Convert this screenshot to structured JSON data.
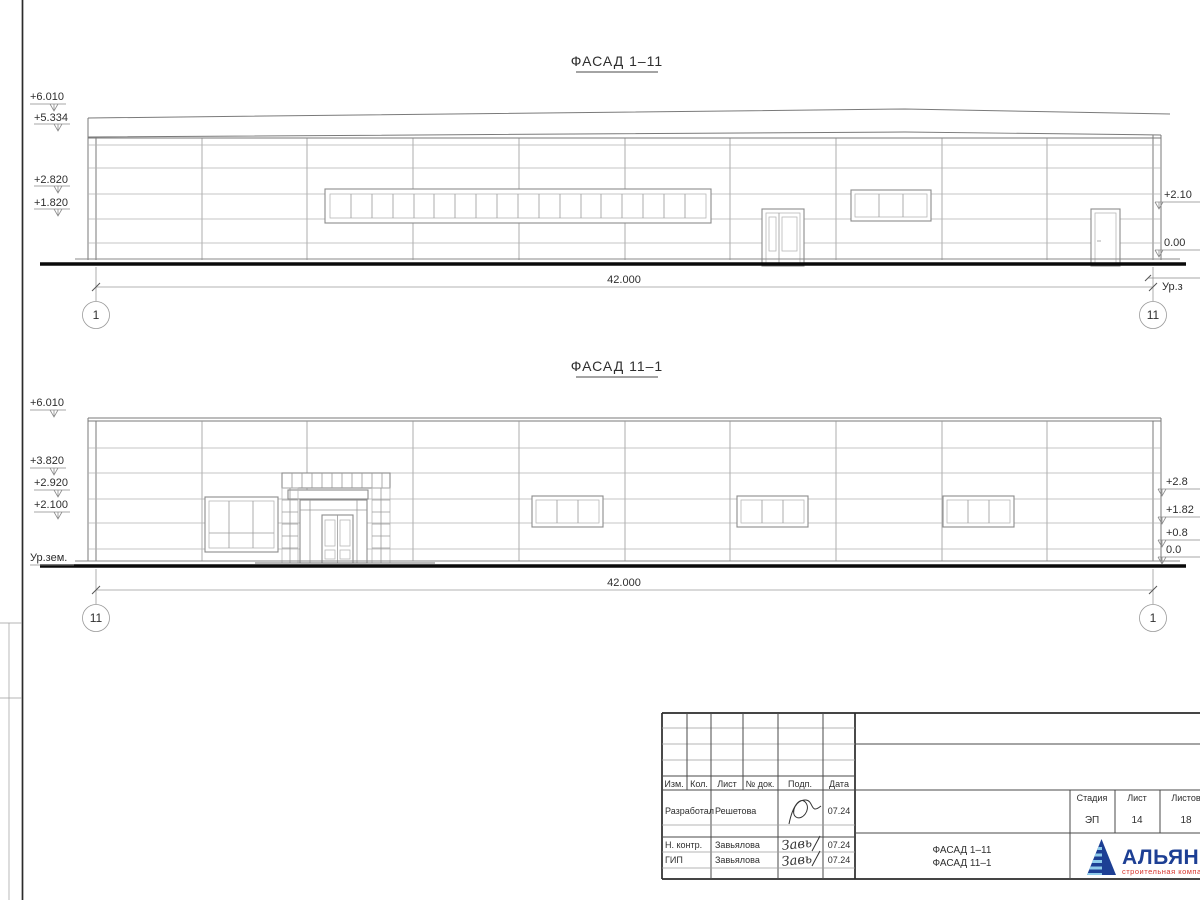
{
  "facade_top": {
    "title": "ФАСАД 1–11",
    "dimension": "42.000",
    "grid_left": "1",
    "grid_right": "11",
    "levels_left": [
      "+6.010",
      "+5.334",
      "+2.820",
      "+1.820"
    ],
    "levels_right": [
      "+2.10",
      "0.00"
    ],
    "ground_label_right": "Ур.з"
  },
  "facade_bottom": {
    "title": "ФАСАД 11–1",
    "dimension": "42.000",
    "grid_left": "11",
    "grid_right": "1",
    "levels_left": [
      "+6.010",
      "+3.820",
      "+2.920",
      "+2.100"
    ],
    "ground_label_left": "Ур.зем.",
    "levels_right": [
      "+2.8",
      "+1.82",
      "+0.8",
      "0.0"
    ]
  },
  "title_block": {
    "columns": [
      "Изм.",
      "Кол.",
      "Лист",
      "№ док.",
      "Подп.",
      "Дата"
    ],
    "rows": [
      {
        "role": "Разработал",
        "name": "Решетова",
        "sig": "",
        "date": "07.24"
      },
      {
        "role": "Н. контр.",
        "name": "Завьялова",
        "sig": "Завь",
        "date": "07.24"
      },
      {
        "role": "ГИП",
        "name": "Завьялова",
        "sig": "Завь",
        "date": "07.24"
      }
    ],
    "stage_label": "Стадия",
    "sheet_label": "Лист",
    "sheets_label": "Листов",
    "stage": "ЭП",
    "sheet_no": "14",
    "sheets_total": "18",
    "drawing_title_line1": "ФАСАД 1–11",
    "drawing_title_line2": "ФАСАД 11–1",
    "logo": {
      "name": "АЛЬЯНС",
      "subtitle": "строительная компания",
      "blue": "#1d3f94",
      "light_blue": "#8ecbea",
      "red": "#d5342c"
    }
  }
}
